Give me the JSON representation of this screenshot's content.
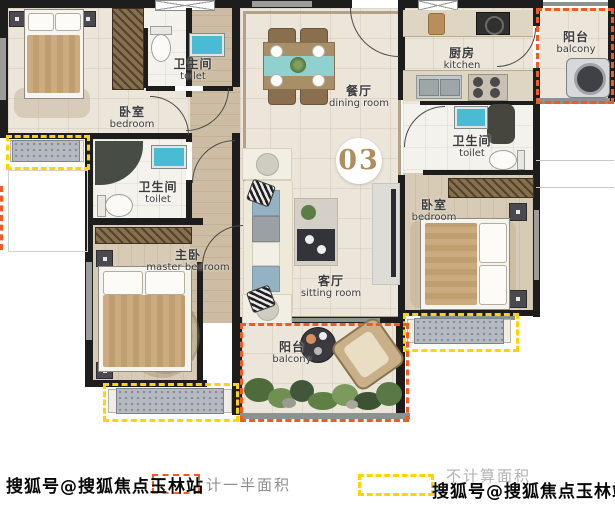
{
  "unit_badge": "03",
  "rooms": {
    "bedroom_tl": {
      "zh": "卧室",
      "en": "bedroom"
    },
    "toilet_top": {
      "zh": "卫生间",
      "en": "toilet"
    },
    "toilet_mid": {
      "zh": "卫生间",
      "en": "toilet"
    },
    "master": {
      "zh": "主卧",
      "en": "master bedroom"
    },
    "dining": {
      "zh": "餐厅",
      "en": "dining room"
    },
    "sitting": {
      "zh": "客厅",
      "en": "sitting room"
    },
    "kitchen": {
      "zh": "厨房",
      "en": "kitchen"
    },
    "toilet_right": {
      "zh": "卫生间",
      "en": "toilet"
    },
    "bedroom_right": {
      "zh": "卧室",
      "en": "bedroom"
    },
    "balcony_tr": {
      "zh": "阳台",
      "en": "balcony"
    },
    "balcony_bottom": {
      "zh": "阳台",
      "en": "balcony"
    }
  },
  "legend": {
    "half_area": {
      "label": "计一半面积",
      "swatch_color": "#f15a24"
    },
    "not_counted": {
      "label": "不计算面积",
      "swatch_color": "#ffd400"
    }
  },
  "watermarks": {
    "bottom_left": "搜狐号@搜狐焦点玉林站",
    "bottom_right": "搜狐号@搜狐焦点玉林站"
  },
  "colors": {
    "wall": "#1d1d1d",
    "accent_orange": "#f15a24",
    "accent_yellow": "#ffd400",
    "fixture_teal": "#49bcd3",
    "badge_text": "#b08d5f"
  }
}
